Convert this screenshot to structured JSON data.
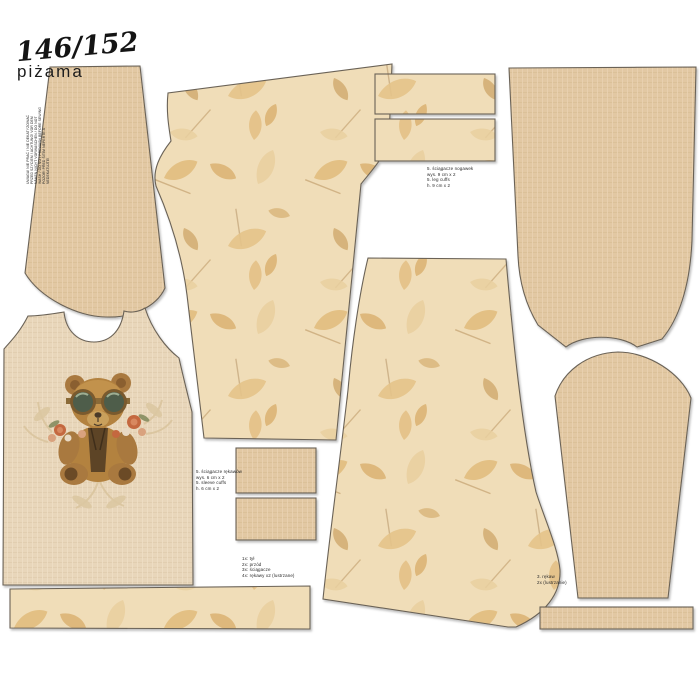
{
  "panel": {
    "size": "146/152",
    "garment": "piżama",
    "care_instructions": "UWAGA! NIE PRAĆ / NIE DEKATYZOWAĆ\nPRZED SZYCIEM / ACHTUNG! VOR DEM\nNÄHEN NICHT VORWASCHEN / DO NOT\nWASH / DO NOT PREWASH BEFORE SEWING\nPOZOR! PŘED ŠITÍM NEPERTE A\nNEDEKATUJTE!"
  },
  "piece_labels": {
    "leg_cuffs": "5. ściągacze nogawek\nwys. 9 cm x 2\n5. leg cuffs\nh. 9 cm x 2",
    "sleeve_cuffs": "5. ściągacze rękawów\nwys. 6 cm x 2\n5. sleeve cuffs\nh. 6 cm x 2",
    "legend": "1x: tył\n2x: przód\n3x: ściągacze\n4x: rękawy x2 (lustrzane)",
    "sleeve_note": "3. rękaw\n2x (lustrzanie)"
  },
  "pieces": [
    {
      "id": "sleeve-upper-left",
      "fabric": "plain-linen"
    },
    {
      "id": "pants-leg-1",
      "fabric": "leaf-print"
    },
    {
      "id": "leg-cuff-1",
      "fabric": "leaf-print"
    },
    {
      "id": "leg-cuff-2",
      "fabric": "leaf-print"
    },
    {
      "id": "back-bodice",
      "fabric": "plain-linen"
    },
    {
      "id": "front-bodice-with-bear",
      "fabric": "plain-linen"
    },
    {
      "id": "pants-leg-2",
      "fabric": "leaf-print"
    },
    {
      "id": "sleeve-lower-right",
      "fabric": "plain-linen"
    },
    {
      "id": "sleeve-cuff-1",
      "fabric": "plain-linen"
    },
    {
      "id": "sleeve-cuff-2",
      "fabric": "plain-linen"
    },
    {
      "id": "waistband-strip-leaf",
      "fabric": "leaf-print"
    },
    {
      "id": "binding-strip-plain",
      "fabric": "plain-linen"
    }
  ],
  "colors": {
    "background": "#ffffff",
    "plain_fabric": "#e2c8a3",
    "plain_fabric_light": "#e8d6ba",
    "print_fabric_bg": "#f0ddb8",
    "leaf_gold": "#e2bd7f",
    "outline": "#6a6257",
    "text": "#1c1c1c",
    "bear_fur": "#b3823f",
    "goggle_lens": "#4e5d4a",
    "flower_rust": "#c4683f"
  }
}
